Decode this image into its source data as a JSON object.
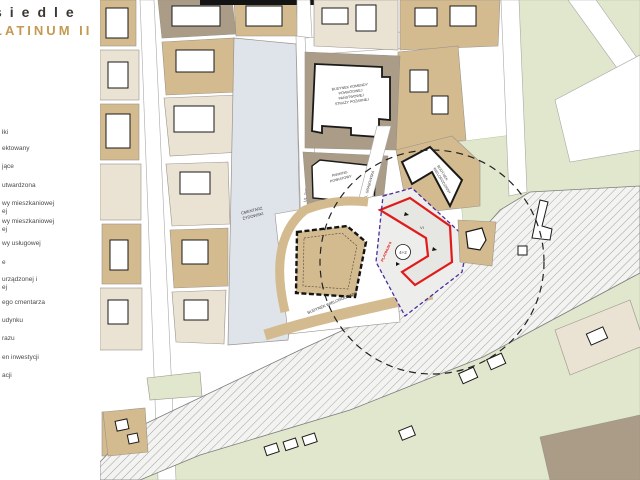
{
  "logo": {
    "top": "siedle",
    "bottom": "LATINUM II"
  },
  "legend": {
    "items": [
      "łki",
      "ektowany",
      "jące",
      "utwardzona",
      "wy mieszkaniowej",
      "ej",
      "wy mieszkaniowej",
      "ej",
      "wy usługowej",
      "e",
      "urządzonej i",
      "ej",
      "ego cmentarza",
      "udynku",
      "razu",
      "en inwestycji",
      "acji"
    ]
  },
  "map": {
    "street_1": "UL. ŻYDOWSKA",
    "street_2": "UL. GRABOWSKA",
    "fire_1": "BUDYNEK KOMENDY",
    "fire_2": "POWIATOWEJ",
    "fire_3": "PAŃSTWOWEJ",
    "fire_4": "STRAŻY POŻARNEJ",
    "parking_1": "PARKING",
    "parking_2": "POWIATOWY",
    "cemetery_1": "CMENTARZ",
    "cemetery_2": "ŻYDOWSKI",
    "building_main": "BUDYNEK WIELORODZINNY",
    "building_north_1": "BUDYNEK",
    "building_north_2": "WIELORODZINNY",
    "badge": "4+2",
    "storeys": "VI",
    "red_note": "PLATINUM II"
  },
  "colors": {
    "accent_gold": "#c49a52",
    "plan_red": "#e01b1b",
    "boundary_purple": "#4a2d9e",
    "parcel_tan": "#d4bb8f",
    "parcel_beige": "#eae2d3",
    "parcel_brown": "#aa9c86",
    "grass_green": "#e0e7cc",
    "cemetery_blue": "#dfe4ea"
  }
}
